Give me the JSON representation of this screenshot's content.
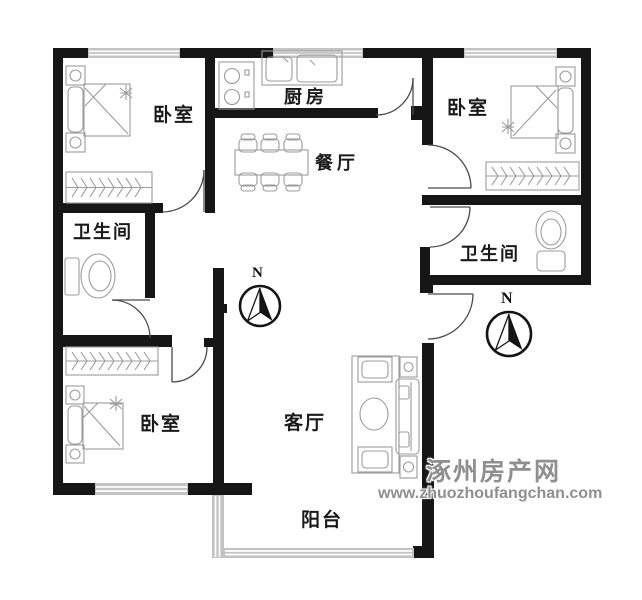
{
  "plan": {
    "rooms": [
      {
        "id": "bedroom-top-left",
        "label": "卧室"
      },
      {
        "id": "kitchen",
        "label": "厨房"
      },
      {
        "id": "dining-room",
        "label": "餐厅"
      },
      {
        "id": "bedroom-top-right",
        "label": "卧室"
      },
      {
        "id": "bathroom-left",
        "label": "卫生间"
      },
      {
        "id": "bathroom-right",
        "label": "卫生间"
      },
      {
        "id": "bedroom-bottom-left",
        "label": "卧室"
      },
      {
        "id": "living-room",
        "label": "客厅"
      },
      {
        "id": "balcony",
        "label": "阳台"
      }
    ],
    "compass": {
      "north_label": "N"
    }
  },
  "watermark": {
    "site_name": "涿州房产网",
    "url": "www.zhuozhoufangchan.com"
  },
  "colors": {
    "wall": "#161616",
    "furniture_line": "#9c9c9c",
    "door_line": "#4a4a4a",
    "window_fill": "#c3c3c3",
    "label_text": "#1a1a1a",
    "watermark_text": "#8f8f8f"
  }
}
